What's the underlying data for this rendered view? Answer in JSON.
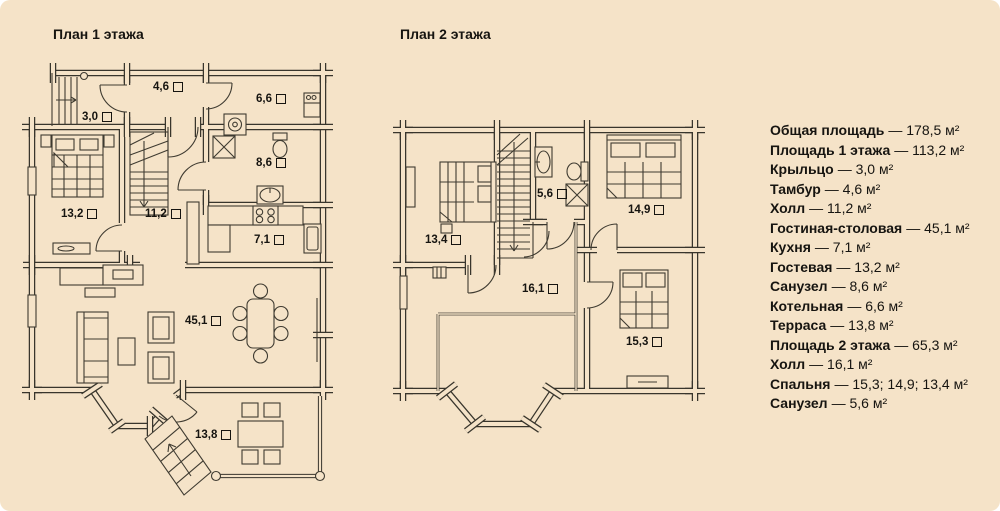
{
  "canvas": {
    "background": "#f5e3c8",
    "line_color": "#38352c",
    "text_color": "#161410"
  },
  "plan1": {
    "title": "План 1 этажа",
    "rooms": [
      {
        "area": "3,0"
      },
      {
        "area": "4,6"
      },
      {
        "area": "6,6"
      },
      {
        "area": "8,6"
      },
      {
        "area": "13,2"
      },
      {
        "area": "11,2"
      },
      {
        "area": "7,1"
      },
      {
        "area": "45,1"
      },
      {
        "area": "13,8"
      }
    ]
  },
  "plan2": {
    "title": "План 2 этажа",
    "rooms": [
      {
        "area": "5,6"
      },
      {
        "area": "14,9"
      },
      {
        "area": "13,4"
      },
      {
        "area": "16,1"
      },
      {
        "area": "15,3"
      }
    ]
  },
  "legend": {
    "items": [
      {
        "name": "Общая площадь",
        "value": "— 178,5 м²"
      },
      {
        "name": "Площадь 1 этажа",
        "value": "— 113,2 м²"
      },
      {
        "name": "Крыльцо",
        "value": "— 3,0 м²"
      },
      {
        "name": "Тамбур",
        "value": "— 4,6 м²"
      },
      {
        "name": "Холл",
        "value": "— 11,2 м²"
      },
      {
        "name": "Гостиная-столовая",
        "value": "— 45,1 м²"
      },
      {
        "name": "Кухня",
        "value": "— 7,1 м²"
      },
      {
        "name": "Гостевая",
        "value": "— 13,2 м²"
      },
      {
        "name": "Санузел",
        "value": "— 8,6 м²"
      },
      {
        "name": "Котельная",
        "value": "— 6,6 м²"
      },
      {
        "name": "Терраса",
        "value": "— 13,8 м²"
      },
      {
        "name": "Площадь 2 этажа",
        "value": "— 65,3 м²"
      },
      {
        "name": "Холл",
        "value": "— 16,1 м²"
      },
      {
        "name": "Спальня",
        "value": "— 15,3; 14,9; 13,4 м²"
      },
      {
        "name": "Санузел",
        "value": "— 5,6 м²"
      }
    ]
  }
}
